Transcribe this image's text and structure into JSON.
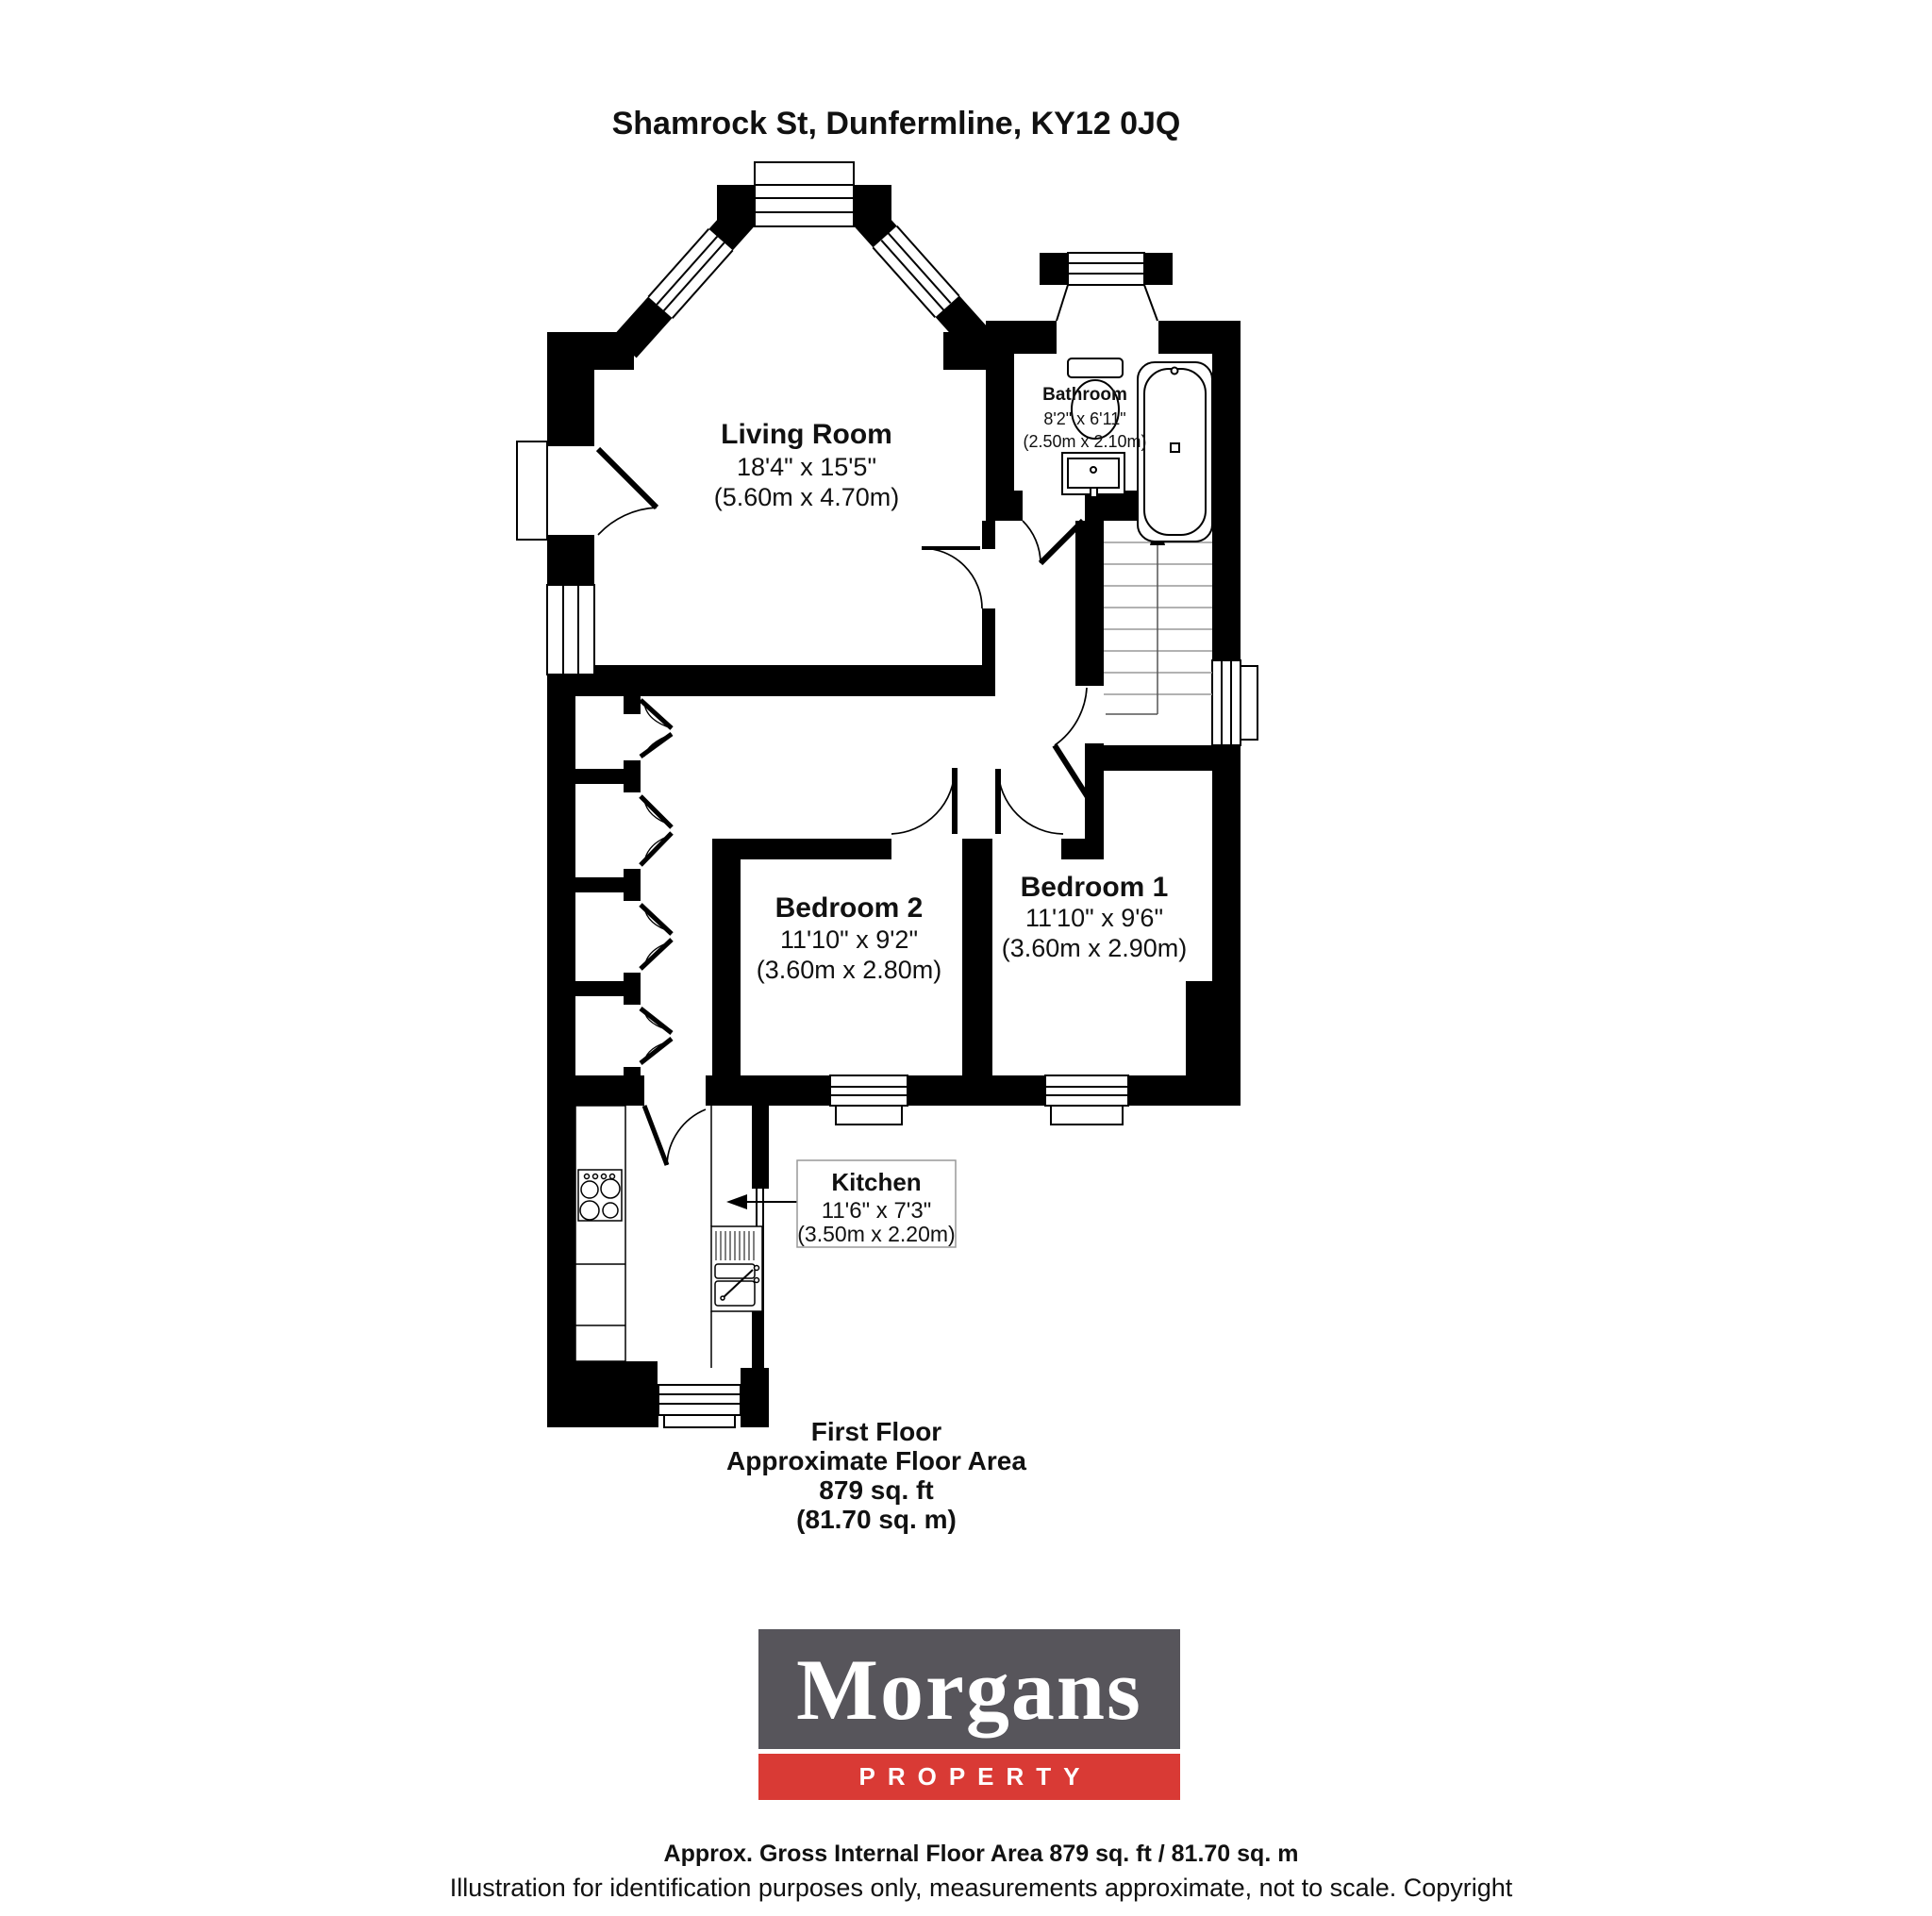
{
  "title": "Shamrock St, Dunfermline, KY12 0JQ",
  "rooms": {
    "living": {
      "name": "Living Room",
      "imperial": "18'4\" x 15'5\"",
      "metric": "(5.60m x 4.70m)"
    },
    "bathroom": {
      "name": "Bathroom",
      "imperial": "8'2\" x 6'11\"",
      "metric": "(2.50m x 2.10m)"
    },
    "bedroom2": {
      "name": "Bedroom 2",
      "imperial": "11'10\" x 9'2\"",
      "metric": "(3.60m x 2.80m)"
    },
    "bedroom1": {
      "name": "Bedroom 1",
      "imperial": "11'10\" x 9'6\"",
      "metric": "(3.60m x 2.90m)"
    },
    "kitchen": {
      "name": "Kitchen",
      "imperial": "11'6\" x 7'3\"",
      "metric": "(3.50m x 2.20m)"
    }
  },
  "floor_summary": {
    "line1": "First Floor",
    "line2": "Approximate Floor Area",
    "line3": "879 sq. ft",
    "line4": "(81.70 sq. m)"
  },
  "logo": {
    "brand": "Morgans",
    "division": "PROPERTY",
    "brand_bg": "#57555b",
    "division_bg": "#d93a35"
  },
  "footer": {
    "line1": "Approx. Gross Internal Floor Area 879 sq. ft / 81.70 sq. m",
    "line2": "Illustration for identification purposes only, measurements approximate, not to scale. Copyright"
  }
}
